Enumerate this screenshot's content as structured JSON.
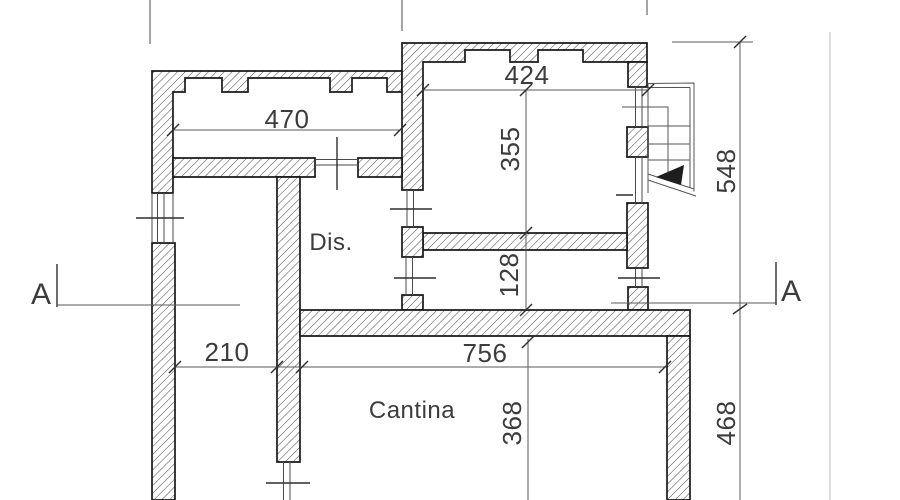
{
  "plan": {
    "rooms": {
      "dis": "Dis.",
      "cantina": "Cantina"
    },
    "dims": {
      "w470": "470",
      "w424": "424",
      "h355": "355",
      "h128": "128",
      "w210": "210",
      "w756": "756",
      "h368": "368",
      "h548": "548",
      "h468": "468"
    },
    "sections": {
      "left_label": "A",
      "right_label": "A"
    },
    "colors": {
      "background": "#ffffff",
      "wall_line": "#191919",
      "thin_line": "#4a4a4a",
      "text": "#3c3c3c",
      "hatch": "#4f4f4f",
      "scan_artifact": "#c9c9c9"
    }
  }
}
